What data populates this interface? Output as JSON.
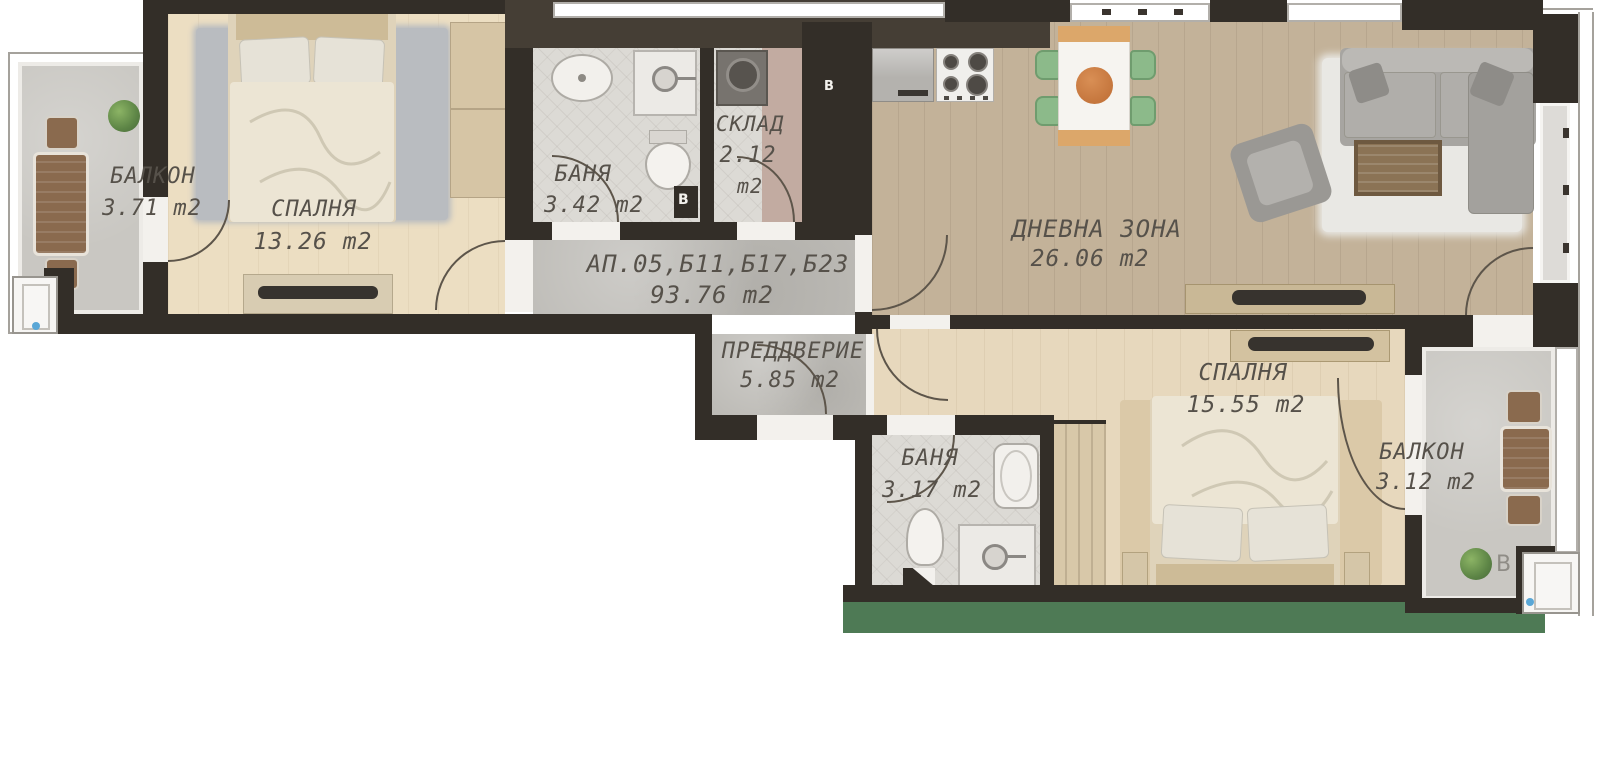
{
  "plan": {
    "type": "apartment-floor-plan",
    "language": "bg",
    "rooms": {
      "balcony_left": {
        "name": "БАЛКОН",
        "area": "3.71 m2"
      },
      "bedroom1": {
        "name": "СПАЛНЯ",
        "area": "13.26 m2"
      },
      "bath1": {
        "name": "БАНЯ",
        "area": "3.42 m2"
      },
      "storage": {
        "name": "СКЛАД",
        "area_value": "2.12",
        "area_unit": "m2"
      },
      "hall": {
        "name": "АП.05,Б11,Б17,Б23",
        "area": "93.76 m2"
      },
      "vestibule": {
        "name": "ПРЕДДВЕРИЕ",
        "area": "5.85 m2"
      },
      "living": {
        "name": "ДНЕВНА ЗОНА",
        "area": "26.06 m2"
      },
      "bath2": {
        "name": "БАНЯ",
        "area": "3.17 m2"
      },
      "bedroom2": {
        "name": "СПАЛНЯ",
        "area": "15.55 m2"
      },
      "balcony_right": {
        "name": "БАЛКОН",
        "area": "3.12 m2"
      }
    },
    "markers": {
      "shaft_letter_bath1": "В",
      "shaft_letter_panel": "В",
      "shaft_letter_balcony": "В"
    },
    "palette": {
      "wall": "#332e28",
      "wall_secondary": "#453e35",
      "wood_light": "#ecdec2",
      "wood_living": "#c3b299",
      "wood_bedroom2": "#e7d8bd",
      "concrete": "#bdbbb6",
      "tile": "#dcdad5",
      "label_text": "#56514a",
      "green_strip": "#4e7a55",
      "chair_green": "#8cba8a",
      "table_wood": "#dca76a",
      "table_center": "#c5763d",
      "balcony_furniture": "#8a6a4e",
      "window_glint": "#5aa7d6"
    }
  }
}
